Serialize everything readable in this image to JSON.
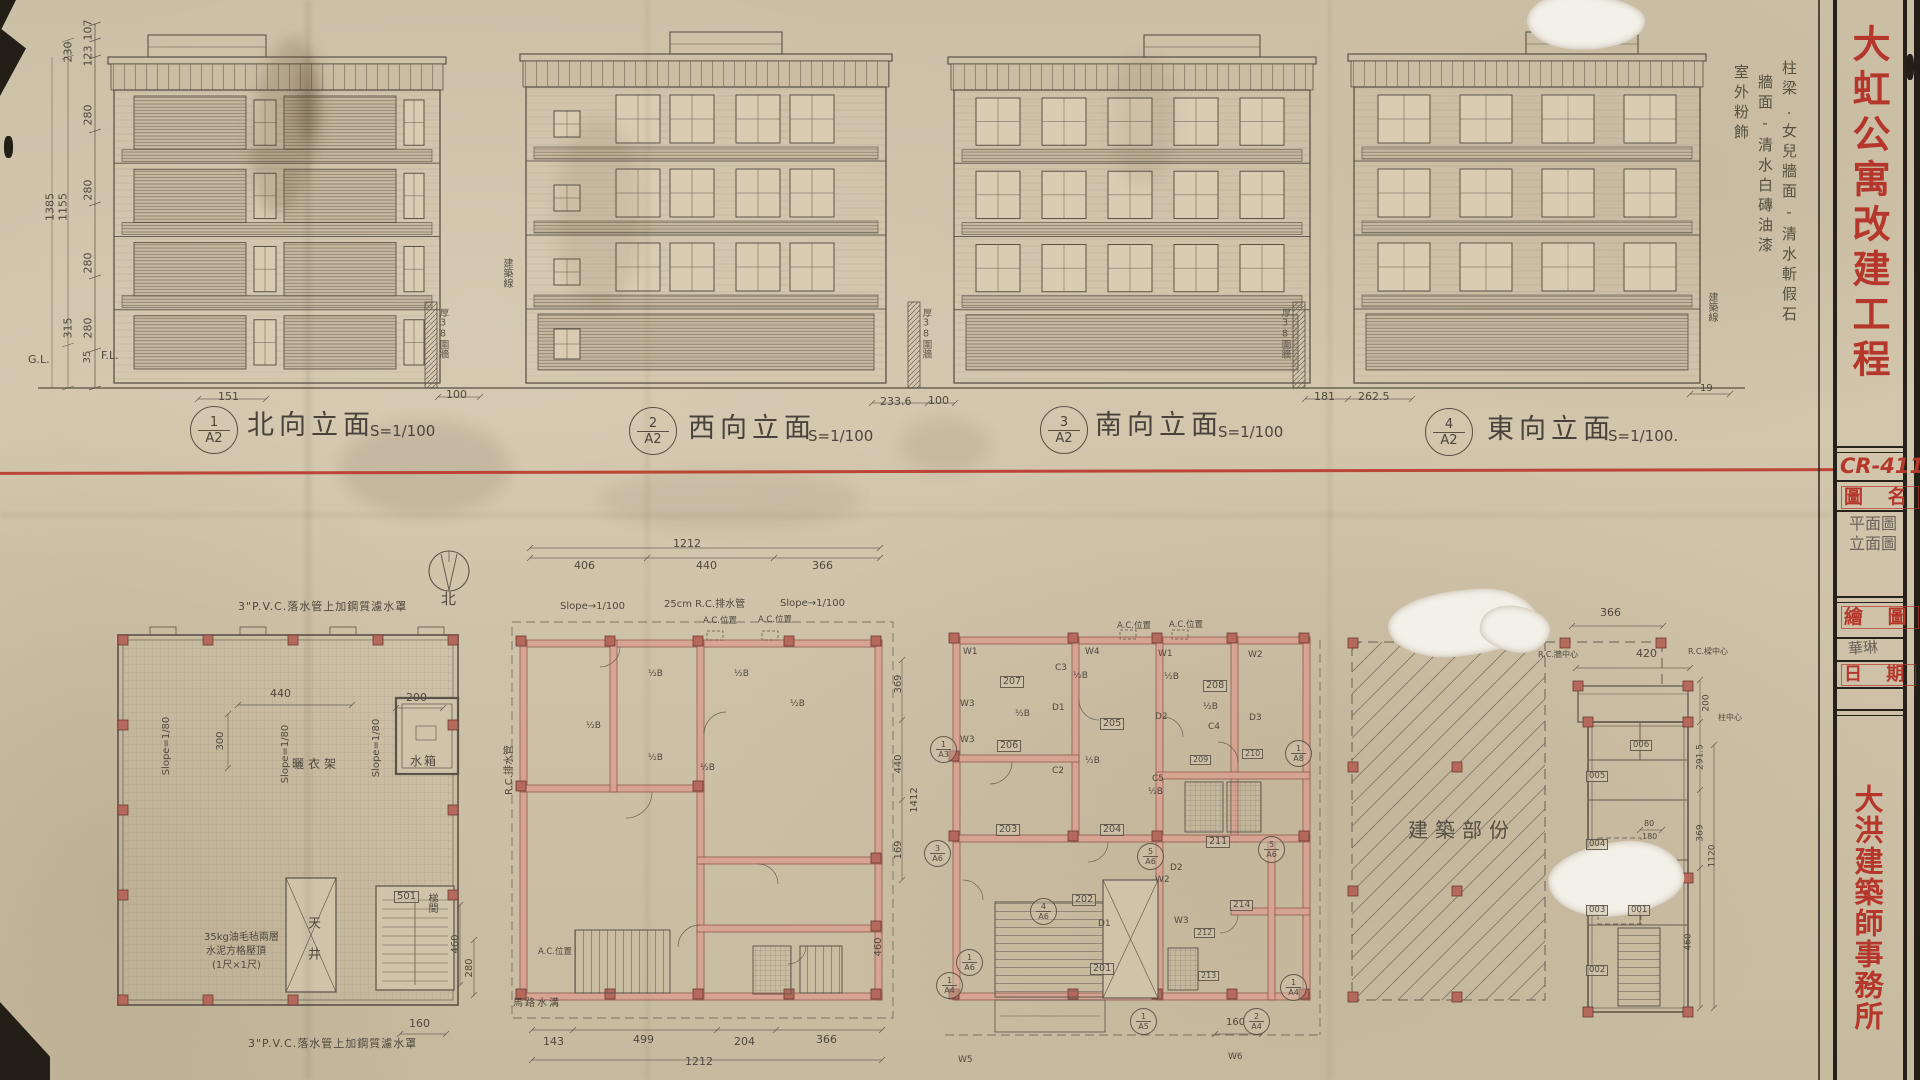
{
  "sheet": {
    "project_title": "大虹公寓改建工程",
    "drawing_no": "CR-411",
    "field_name_label": "圖 名",
    "drawing_name_line1": "平面圖",
    "drawing_name_line2": "立面圖",
    "field_drafter_label": "繪 圖",
    "drafter_signature": "華琳",
    "field_date_label": "日 期",
    "firm_name": "大洪建築師事務所"
  },
  "colors": {
    "stamp_red": "#b5372c",
    "divider_red": "#bb3a2c",
    "paper": "#cdc1a8",
    "pencil": "#554e44",
    "wall_pink": "#d9a292"
  },
  "elevations": [
    {
      "tag_no": "1",
      "tag_sheet": "A2",
      "title": "北向立面",
      "scale": "S=1/100"
    },
    {
      "tag_no": "2",
      "tag_sheet": "A2",
      "title": "西向立面",
      "scale": "S=1/100"
    },
    {
      "tag_no": "3",
      "tag_sheet": "A2",
      "title": "南向立面",
      "scale": "S=1/100"
    },
    {
      "tag_no": "4",
      "tag_sheet": "A2",
      "title": "東向立面",
      "scale": "S=1/100."
    }
  ],
  "elev_notes": {
    "finish_col1": "柱梁.女兒牆面-清水斬假石",
    "finish_col2": "牆面-清水白磚油漆",
    "finish_col3": "室外粉飾",
    "building_line": "建築線",
    "fence_wall": "厚38圍牆",
    "gl": "G.L.",
    "fl": "F.L."
  },
  "left_dims": [
    "107",
    "123",
    "230",
    "280",
    "280",
    "280",
    "280",
    "315",
    "35"
  ],
  "left_totals": [
    "1385",
    "1155"
  ],
  "bottom_dims": [
    "151",
    "100",
    "233.6",
    "100",
    "181",
    "262.5",
    "19"
  ],
  "compass_north": "北",
  "roof_plan": {
    "note_top": "3\"P.V.C.落水管上加鋼質濾水罩",
    "note_bottom": "3\"P.V.C.落水管上加鋼質濾水罩",
    "paving_note_l1": "35kg油毛毡兩層",
    "paving_note_l2": "水泥方格壓頂",
    "paving_note_l3": "(1尺×1尺)",
    "slope_label": "Slope=1/80",
    "water_tank": "水箱",
    "drying_rack": "曬衣架",
    "light_well": "天井",
    "stair_room": "梯間",
    "room_tag": "501",
    "dim_440": "440",
    "dim_200": "200",
    "dim_300": "300",
    "dim_160": "160",
    "dim_460": "460",
    "dim_280": "280"
  },
  "plan2": {
    "dim_total_top": "1212",
    "dim_top_1": "406",
    "dim_top_2": "440",
    "dim_top_3": "366",
    "slope_label": "Slope→1/100",
    "rc_pipe_note": "25cm R.C.排水管",
    "ac_note": "A.C.位置",
    "rc_pipe_v": "R.C.排水管",
    "half_b": "½B",
    "gutter_note": "馬路水溝",
    "dim_b1": "143",
    "dim_b2": "499",
    "dim_b3": "204",
    "dim_b4": "366",
    "dim_total_bottom": "1212",
    "dim_r1": "369",
    "dim_r2": "440",
    "dim_r3": "1412",
    "dim_r4": "169",
    "dim_r5": "460"
  },
  "plan3": {
    "rooms": {
      "r201": "201",
      "r202": "202",
      "r203": "203",
      "r204": "204",
      "r205": "205",
      "r206": "206",
      "r207": "207",
      "r208": "208",
      "r209": "209",
      "r210": "210",
      "r211": "211",
      "r212": "212",
      "r213": "213",
      "r214": "214"
    },
    "marks": {
      "w1": "W1",
      "w2": "W2",
      "w3": "W3",
      "w4": "W4",
      "w5": "W5",
      "w6": "W6",
      "c2": "C2",
      "c3": "C3",
      "c4": "C4",
      "c5": "C5",
      "d1": "D1",
      "d2": "D2",
      "d3": "D3",
      "half_b": "½B",
      "ac": "A.C.位置",
      "dim_160": "160"
    },
    "bubbles": {
      "b1n": "1",
      "b1s": "A3",
      "b2n": "1",
      "b2s": "A8",
      "b3n": "3",
      "b3s": "A6",
      "b4n": "4",
      "b4s": "A6",
      "b5n": "5",
      "b5s": "A6",
      "b6n": "1",
      "b6s": "A4",
      "b7n": "1",
      "b7s": "A4",
      "b8n": "1",
      "b8s": "A5",
      "b9n": "2",
      "b9s": "A4",
      "b10n": "1",
      "b10s": "A6"
    }
  },
  "existing_label": "建築部份",
  "plan4": {
    "rooms": {
      "r001": "001",
      "r002": "002",
      "r003": "003",
      "r004": "004",
      "r005": "005",
      "r006": "006"
    },
    "dim_366": "366",
    "rc_wall": "R.C.牆中心",
    "dim_420": "420",
    "rc_beam": "R.C.樑中心",
    "col_center": "柱中心",
    "dim_200": "200",
    "dim_2915": "291.5",
    "dim_369": "369",
    "dim_80": "80",
    "dim_180": "180",
    "dim_460": "460",
    "dim_1120": "1120"
  }
}
